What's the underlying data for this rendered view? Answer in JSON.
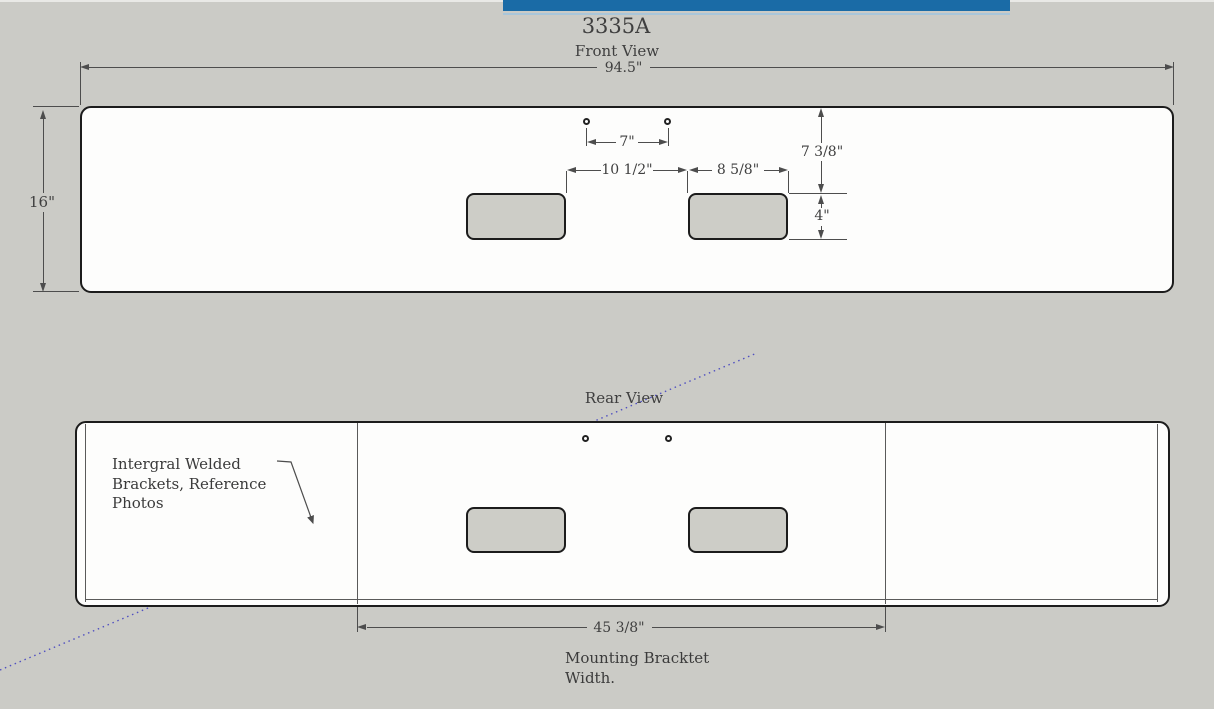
{
  "title": "3335A",
  "front_view": {
    "label": "Front View",
    "overall_width": "94.5\"",
    "overall_height": "16\"",
    "hole_spacing": "7\"",
    "recess_gap": "10 1/2\"",
    "recess_width": "8 5/8\"",
    "top_edge_to_recess": "7 3/8\"",
    "recess_height": "4\""
  },
  "rear_view": {
    "label": "Rear View",
    "note_line1": "Intergral Welded",
    "note_line2": "Brackets, Reference",
    "note_line3": "Photos",
    "mounting_bracket_width": "45 3/8\"",
    "caption_line1": "Mounting Bracktet",
    "caption_line2": "Width."
  },
  "colors": {
    "background": "#cbcbc6",
    "accent_bar": "#1a6ba6",
    "accent_bar_underline": "#a9c6da",
    "outline": "#1c1c1c",
    "dimension_lines": "#4d4d4d",
    "dotted_reference_line": "#5050c0",
    "recess_fill": "#cdcdc7",
    "bumper_fill": "#fdfdfc"
  }
}
